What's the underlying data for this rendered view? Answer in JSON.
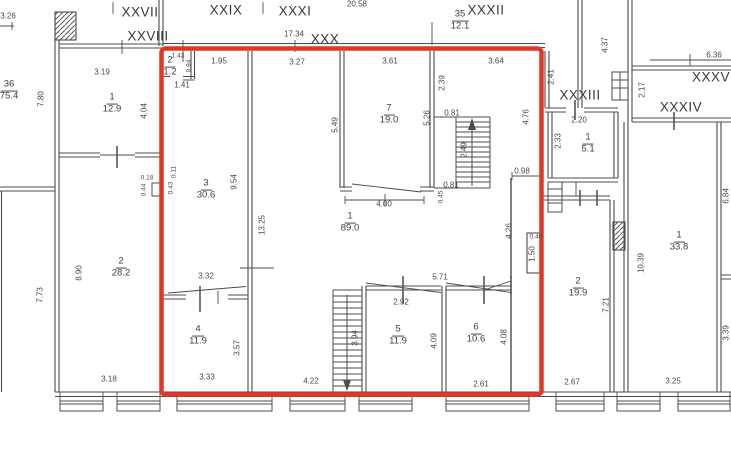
{
  "plan": {
    "type": "technical floor plan (BTI)",
    "colors": {
      "outline": "#df3826",
      "wall": "#4c4c4c",
      "text": "#414141"
    },
    "premises": [
      {
        "label": "XXVII",
        "x": 140,
        "y": 12
      },
      {
        "label": "XXIX",
        "x": 226,
        "y": 10
      },
      {
        "label": "XXVIII",
        "x": 148,
        "y": 36
      },
      {
        "label": "XXXI",
        "x": 295,
        "y": 11
      },
      {
        "label": "XXX",
        "x": 325,
        "y": 39
      },
      {
        "label": "XXXII",
        "x": 486,
        "y": 10
      },
      {
        "label": "XXXIII",
        "x": 580,
        "y": 95
      },
      {
        "label": "XXXIV",
        "x": 681,
        "y": 107
      },
      {
        "label": "XXXV",
        "x": 711,
        "y": 77
      }
    ],
    "rooms": [
      {
        "number": "36",
        "area": "75.4",
        "x": 9,
        "y": 91
      },
      {
        "number": "1",
        "area": "12.9",
        "x": 112,
        "y": 104
      },
      {
        "number": "2",
        "area": "28.2",
        "x": 121,
        "y": 268
      },
      {
        "number": "35",
        "area": "12.1",
        "x": 460,
        "y": 21
      },
      {
        "number": "2",
        "area": "1.2",
        "x": 170,
        "y": 67
      },
      {
        "number": "3",
        "area": "30.6",
        "x": 206,
        "y": 190
      },
      {
        "number": "7",
        "area": "19.0",
        "x": 389,
        "y": 115
      },
      {
        "number": "1",
        "area": "89.0",
        "x": 350,
        "y": 223
      },
      {
        "number": "4",
        "area": "11.9",
        "x": 198,
        "y": 336
      },
      {
        "number": "5",
        "area": "11.9",
        "x": 398,
        "y": 336
      },
      {
        "number": "6",
        "area": "10.6",
        "x": 476,
        "y": 334
      },
      {
        "number": "1",
        "area": "5.1",
        "x": 588,
        "y": 144
      },
      {
        "number": "2",
        "area": "19.9",
        "x": 578,
        "y": 288
      },
      {
        "number": "1",
        "area": "33.8",
        "x": 679,
        "y": 242
      }
    ],
    "dimensions": [
      {
        "value": "20.58",
        "x": 357,
        "y": 4,
        "vertical": false
      },
      {
        "value": "17.34",
        "x": 294,
        "y": 34,
        "vertical": false
      },
      {
        "value": "3.26",
        "x": 8,
        "y": 16,
        "vertical": false
      },
      {
        "value": "3.19",
        "x": 102,
        "y": 72,
        "vertical": false
      },
      {
        "value": "1.95",
        "x": 219,
        "y": 61,
        "vertical": false
      },
      {
        "value": "3.27",
        "x": 297,
        "y": 62,
        "vertical": false
      },
      {
        "value": "3.61",
        "x": 390,
        "y": 61,
        "vertical": false
      },
      {
        "value": "3.64",
        "x": 496,
        "y": 61,
        "vertical": false
      },
      {
        "value": "6.36",
        "x": 714,
        "y": 55,
        "vertical": false
      },
      {
        "value": "1.43",
        "x": 178,
        "y": 56,
        "vertical": false,
        "small": true
      },
      {
        "value": "0.94",
        "x": 189,
        "y": 66,
        "vertical": true,
        "small": true
      },
      {
        "value": "1.41",
        "x": 182,
        "y": 85,
        "vertical": false
      },
      {
        "value": "7.80",
        "x": 41,
        "y": 99,
        "vertical": true
      },
      {
        "value": "4.04",
        "x": 144,
        "y": 111,
        "vertical": true
      },
      {
        "value": "2.41",
        "x": 551,
        "y": 77,
        "vertical": true
      },
      {
        "value": "4.37",
        "x": 605,
        "y": 45,
        "vertical": true
      },
      {
        "value": "2.17",
        "x": 642,
        "y": 90,
        "vertical": true
      },
      {
        "value": "2.20",
        "x": 579,
        "y": 120,
        "vertical": false
      },
      {
        "value": "2.33",
        "x": 558,
        "y": 141,
        "vertical": true
      },
      {
        "value": "2.39",
        "x": 442,
        "y": 83,
        "vertical": true
      },
      {
        "value": "5.49",
        "x": 335,
        "y": 125,
        "vertical": true
      },
      {
        "value": "5.26",
        "x": 427,
        "y": 118,
        "vertical": true
      },
      {
        "value": "0.81",
        "x": 452,
        "y": 113,
        "vertical": false
      },
      {
        "value": "0.81",
        "x": 451,
        "y": 185,
        "vertical": false
      },
      {
        "value": "0.45",
        "x": 441,
        "y": 197,
        "vertical": true,
        "small": true
      },
      {
        "value": "2.49",
        "x": 464,
        "y": 150,
        "vertical": true
      },
      {
        "value": "4.76",
        "x": 526,
        "y": 117,
        "vertical": true
      },
      {
        "value": "4.00",
        "x": 384,
        "y": 204,
        "vertical": false
      },
      {
        "value": "0.98",
        "x": 522,
        "y": 171,
        "vertical": false
      },
      {
        "value": "4.26",
        "x": 509,
        "y": 231,
        "vertical": true
      },
      {
        "value": "1.50",
        "x": 532,
        "y": 254,
        "vertical": true
      },
      {
        "value": "0.40",
        "x": 536,
        "y": 237,
        "vertical": false,
        "small": true
      },
      {
        "value": "0.43",
        "x": 171,
        "y": 188,
        "vertical": true,
        "small": true
      },
      {
        "value": "0.11",
        "x": 174,
        "y": 172,
        "vertical": true,
        "small": true
      },
      {
        "value": "9.54",
        "x": 234,
        "y": 182,
        "vertical": true
      },
      {
        "value": "13.25",
        "x": 262,
        "y": 225,
        "vertical": true
      },
      {
        "value": "0.18",
        "x": 147,
        "y": 178,
        "vertical": false,
        "small": true
      },
      {
        "value": "0.44",
        "x": 144,
        "y": 190,
        "vertical": true,
        "small": true
      },
      {
        "value": "8.90",
        "x": 79,
        "y": 273,
        "vertical": true
      },
      {
        "value": "7.73",
        "x": 40,
        "y": 295,
        "vertical": true
      },
      {
        "value": "3.32",
        "x": 206,
        "y": 276,
        "vertical": false
      },
      {
        "value": "3.57",
        "x": 237,
        "y": 348,
        "vertical": true
      },
      {
        "value": "3.33",
        "x": 207,
        "y": 377,
        "vertical": false
      },
      {
        "value": "3.18",
        "x": 109,
        "y": 379,
        "vertical": false
      },
      {
        "value": "4.22",
        "x": 311,
        "y": 381,
        "vertical": false
      },
      {
        "value": "3.94",
        "x": 355,
        "y": 338,
        "vertical": true
      },
      {
        "value": "5.71",
        "x": 440,
        "y": 277,
        "vertical": false
      },
      {
        "value": "2.92",
        "x": 401,
        "y": 302,
        "vertical": false
      },
      {
        "value": "4.09",
        "x": 434,
        "y": 341,
        "vertical": true
      },
      {
        "value": "4.08",
        "x": 504,
        "y": 337,
        "vertical": true
      },
      {
        "value": "2.61",
        "x": 481,
        "y": 384,
        "vertical": false
      },
      {
        "value": "2.67",
        "x": 572,
        "y": 382,
        "vertical": false
      },
      {
        "value": "7.21",
        "x": 606,
        "y": 305,
        "vertical": true
      },
      {
        "value": "10.39",
        "x": 641,
        "y": 263,
        "vertical": true
      },
      {
        "value": "3.25",
        "x": 673,
        "y": 381,
        "vertical": false
      },
      {
        "value": "3.39",
        "x": 726,
        "y": 333,
        "vertical": true
      },
      {
        "value": "6.84",
        "x": 726,
        "y": 196,
        "vertical": true
      }
    ]
  }
}
